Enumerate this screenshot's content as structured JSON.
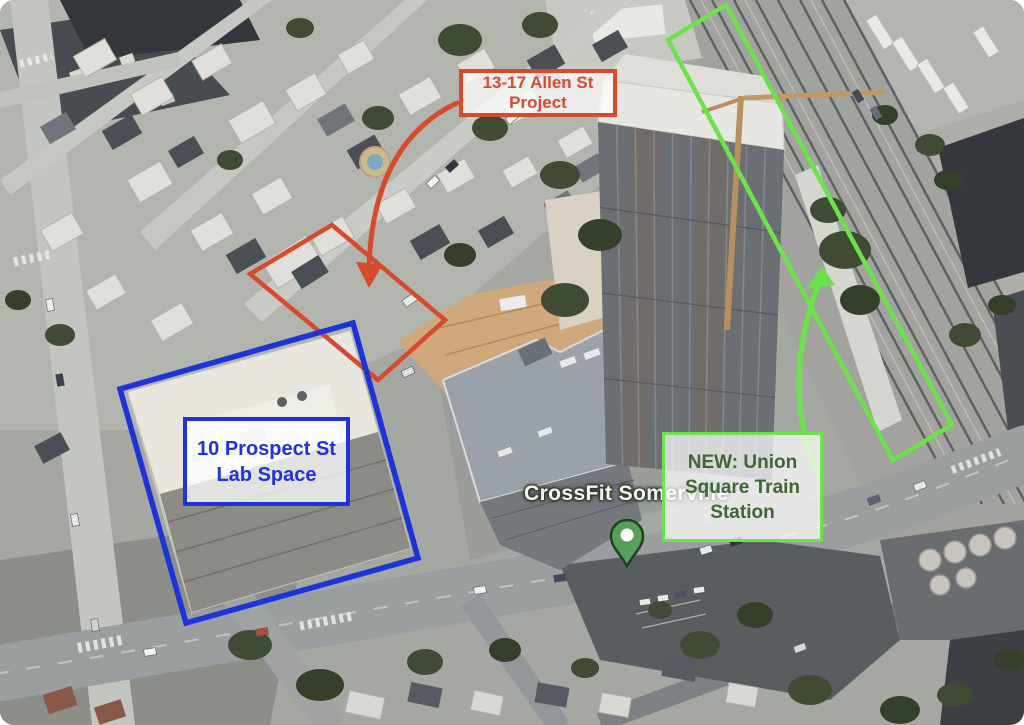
{
  "annotations": {
    "allen": {
      "label_lines": [
        "13-17 Allen St",
        "Project"
      ],
      "color": "#d64a2d",
      "polygon": "332,225 445,320 378,380 250,274",
      "arrow_path": "M 457,103 Q 372,143 369,270",
      "arrowhead": "369,288 356,262 383,264"
    },
    "prospect": {
      "label_lines": [
        "10 Prospect St",
        "Lab Space"
      ],
      "color": "#1e33d8",
      "polygon": "353,323 418,558 186,623 120,389"
    },
    "station": {
      "label_lines": [
        "NEW: Union",
        "Square Train",
        "Station"
      ],
      "border_color": "#6de24c",
      "text_color": "#3e6833",
      "polygon": "726,5 668,40 893,460 952,425",
      "arrow_path": "M 818,474 Q 779,385 820,280",
      "arrowhead": "822,266 806,289 835,285"
    }
  },
  "map_label": {
    "text": "CrossFit Somerville",
    "pin_color": "#57a05b",
    "pin_border": "#24411f"
  }
}
